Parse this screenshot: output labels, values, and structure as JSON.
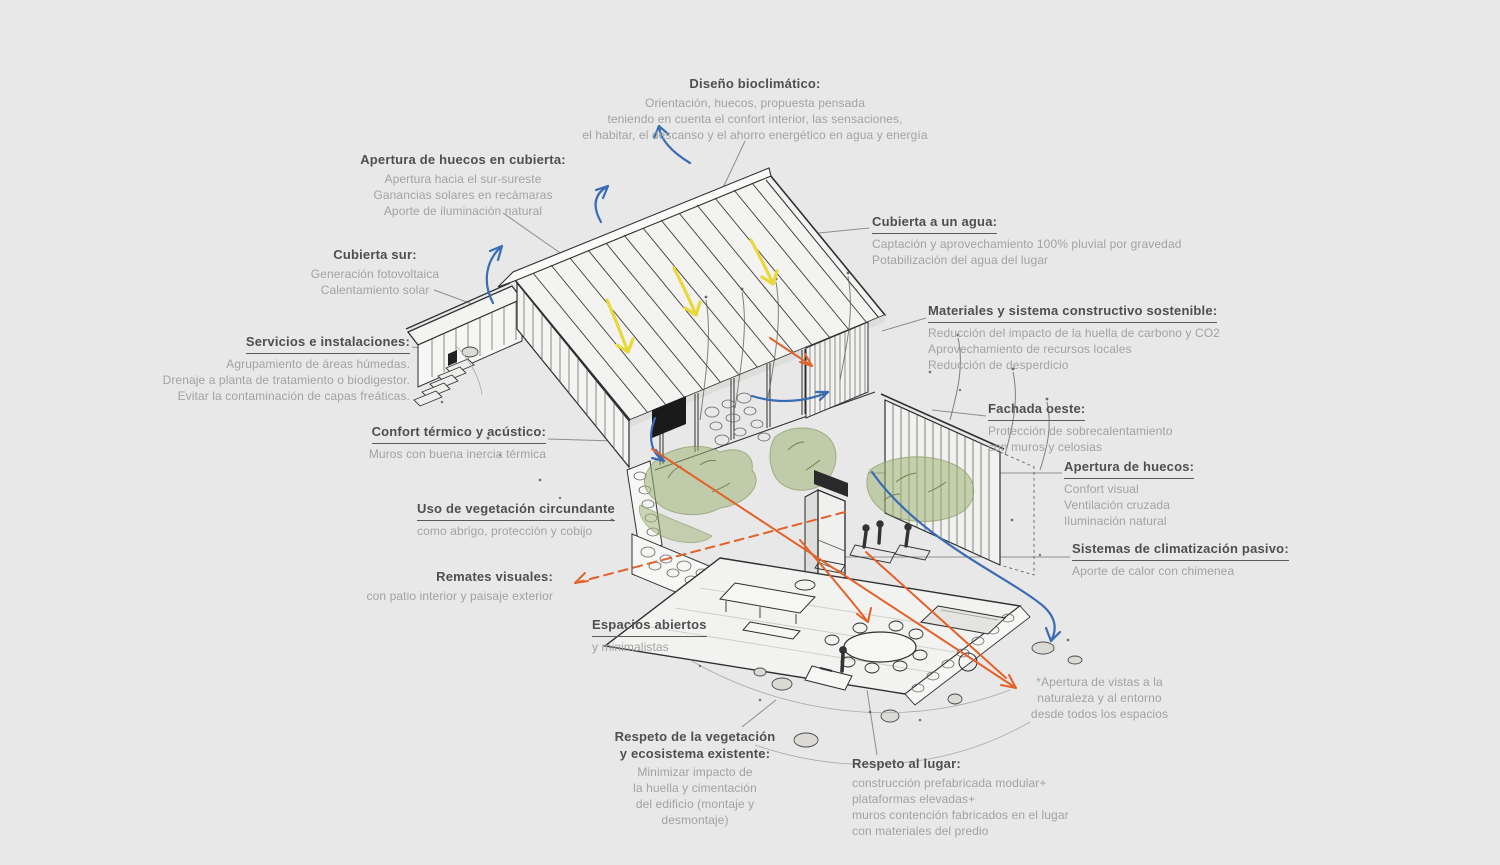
{
  "page": {
    "background": "#e8e8e8",
    "colors": {
      "ink": "#2f2f2f",
      "title_text": "#4f4f4f",
      "body_text": "#a2a2a2",
      "leader_line": "#8f8f8f",
      "airflow_blue": "#3a6cb3",
      "sun_yellow": "#e9d83a",
      "views_orange": "#e2622a",
      "vegetation_green": "#9fb274"
    }
  },
  "annotations": {
    "diseno": {
      "title": "Diseño bioclimático:",
      "body": "Orientación, huecos, propuesta pensada\nteniendo en cuenta el confort interior, las sensaciones,\nel habitar, el descanso y el ahorro energético en agua y energía"
    },
    "aperturaCubierta": {
      "title": "Apertura de huecos en cubierta:",
      "body": "Apertura hacia el sur-sureste\nGanancias solares en recámaras\nAporte de iluminación natural"
    },
    "cubiertaSur": {
      "title": "Cubierta sur:",
      "body": "Generación fotovoltaica\nCalentamiento solar"
    },
    "cubiertaAgua": {
      "title": "Cubierta a un agua:",
      "body": "Captación y aprovechamiento 100% pluvial por gravedad\nPotabilización del agua del lugar"
    },
    "servicios": {
      "title": "Servicios e instalaciones:",
      "body": "Agrupamiento de áreas húmedas.\nDrenaje a planta de tratamiento o biodigestor.\nEvitar la contaminación de capas freáticas."
    },
    "materiales": {
      "title": "Materiales y sistema constructivo sostenible:",
      "body": "Reducción del impacto de la huella de carbono y CO2\nAprovechamiento de recursos locales\nReducción de desperdicio"
    },
    "confort": {
      "title": "Confort térmico y acústico:",
      "body": "Muros con buena inercia térmica"
    },
    "fachadaOeste": {
      "title": "Fachada oeste:",
      "body": "Protección de sobrecalentamiento\ncon muros y celosias"
    },
    "aperturaHuecos": {
      "title": "Apertura de huecos:",
      "body": "Confort visual\nVentilación cruzada\nIluminación natural"
    },
    "vegetacion": {
      "title": "Uso de vegetación circundante",
      "body": "como abrigo, protección y cobijo"
    },
    "remates": {
      "title": "Remates visuales:",
      "body": "con patio interior y paisaje exterior"
    },
    "climatizacion": {
      "title": "Sistemas de climatización pasivo:",
      "body": "Aporte de calor con chimenea"
    },
    "espacios": {
      "title": "Espacios abiertos",
      "body": "y minimalistas"
    },
    "respetoVegetacion": {
      "title": "Respeto de la vegetación\ny ecosistema existente:",
      "body": "Minimizar impacto de\nla huella y cimentación\ndel edificio (montaje y\ndesmontaje)"
    },
    "respetoLugar": {
      "title": "Respeto al lugar:",
      "body": "construcción prefabricada modular+\nplataformas elevadas+\nmuros contención fabricados en el lugar\ncon materiales del predio"
    },
    "vistas": {
      "body": "*Apertura de vistas a la\nnaturaleza y al entorno\ndesde todos los espacios"
    }
  }
}
